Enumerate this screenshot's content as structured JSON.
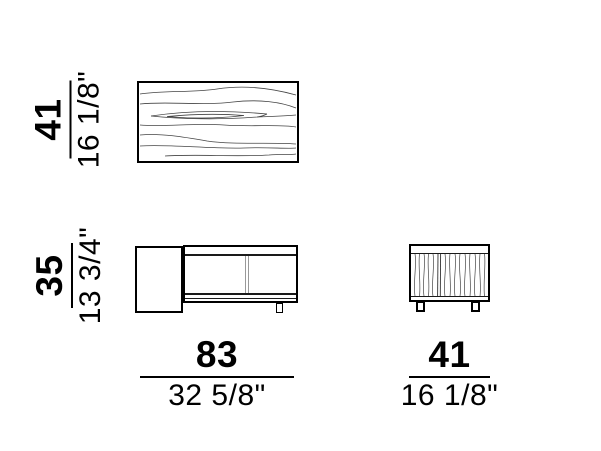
{
  "drawing_title": "sideboard-dimension-drawing",
  "units": {
    "primary": "cm",
    "secondary": "inches"
  },
  "labels": {
    "top_depth": {
      "cm": "41",
      "inches": "16 1/8\""
    },
    "front_height": {
      "cm": "35",
      "inches": "13 3/4\""
    },
    "front_width": {
      "cm": "83",
      "inches": "32 5/8\""
    },
    "side_depth": {
      "cm": "41",
      "inches": "16 1/8\""
    }
  },
  "colors": {
    "background": "#ffffff",
    "outline": "#000000",
    "hairline": "#1a1a1a",
    "grain": "#444444",
    "door_gap": "#999999"
  }
}
